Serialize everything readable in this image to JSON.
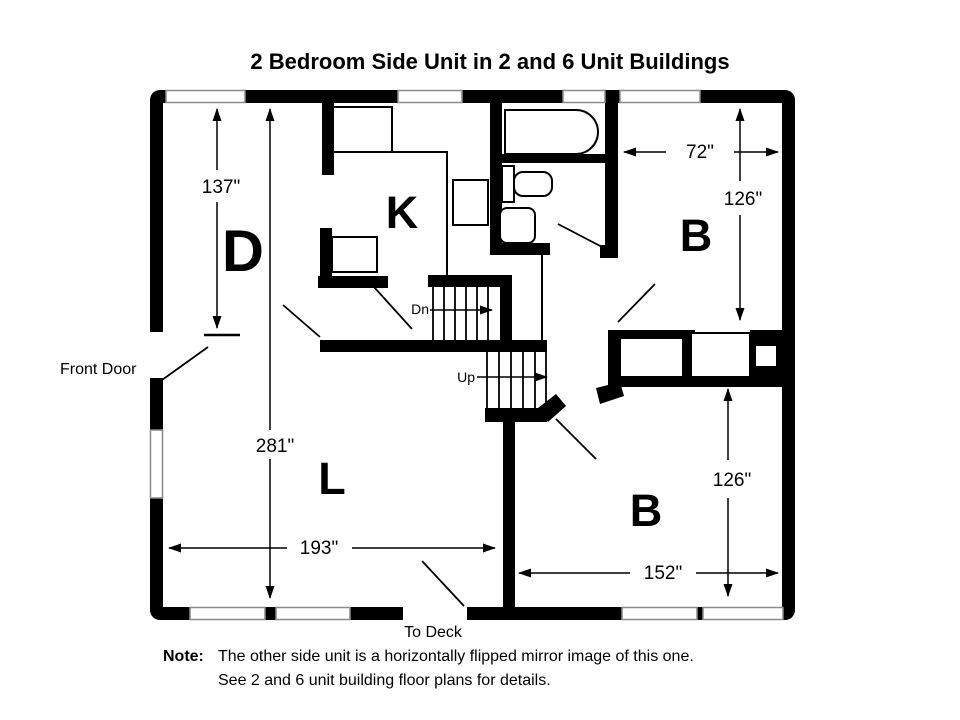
{
  "title": "2 Bedroom Side Unit in 2 and 6 Unit Buildings",
  "rooms": {
    "dining": "D",
    "kitchen": "K",
    "living": "L",
    "bedroom_upper": "B",
    "bedroom_lower": "B"
  },
  "dimensions": {
    "dining_length": "137\"",
    "unit_length": "281\"",
    "living_width": "193\"",
    "bedroom_upper_width": "72\"",
    "bedroom_upper_length": "126\"",
    "bedroom_lower_length": "126\"",
    "bedroom_lower_width": "152\""
  },
  "labels": {
    "front_door": "Front Door",
    "to_deck": "To Deck",
    "stairs_down": "Dn",
    "stairs_up": "Up"
  },
  "note": {
    "prefix": "Note:",
    "line1": "The other side unit is a horizontally flipped mirror image of this one.",
    "line2": "See 2 and 6 unit building floor plans for details."
  },
  "colors": {
    "wall": "#000000",
    "background": "#ffffff",
    "window_outline": "#8a8a8a"
  }
}
